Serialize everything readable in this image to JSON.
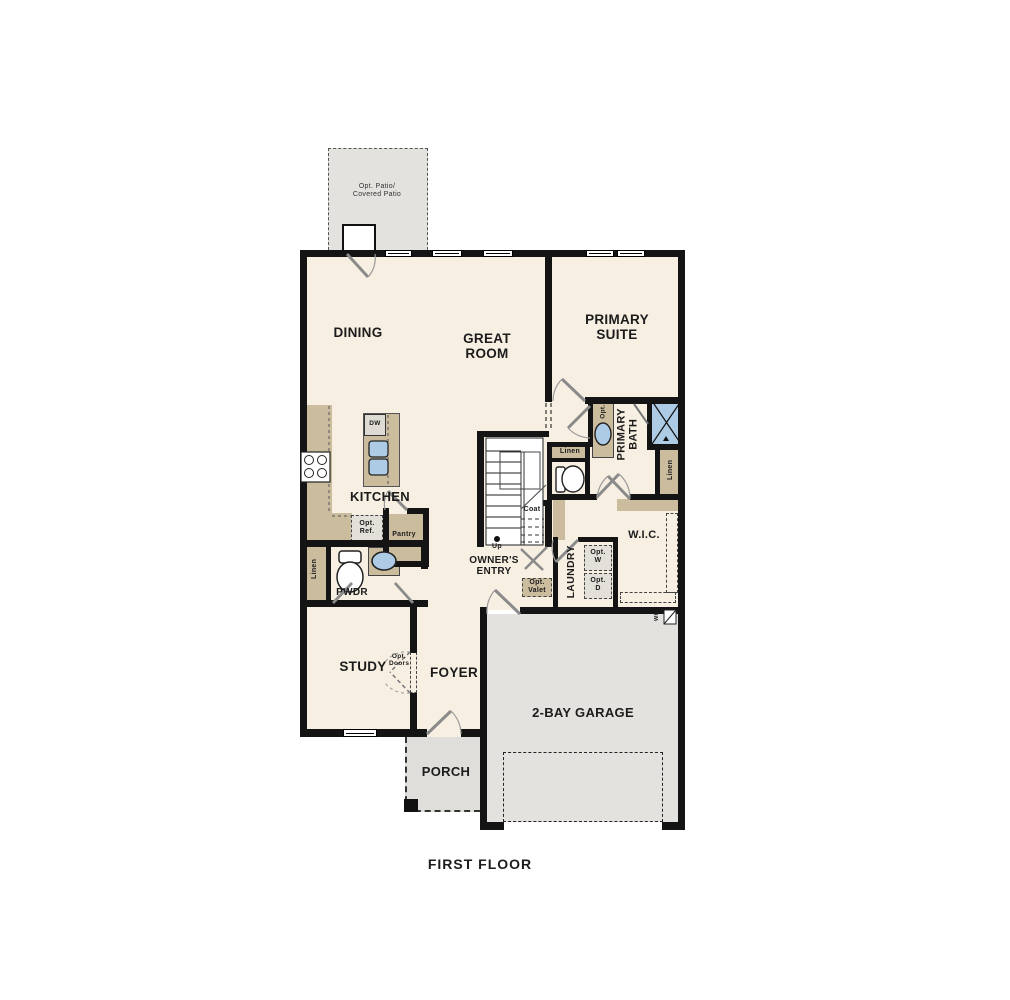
{
  "title": "FIRST FLOOR",
  "rooms": {
    "patio": {
      "label": "Opt. Patio/ Covered Patio"
    },
    "dining": {
      "label": "DINING"
    },
    "great_room": {
      "label": "GREAT ROOM"
    },
    "primary_suite": {
      "label": "PRIMARY SUITE"
    },
    "kitchen": {
      "label": "KITCHEN"
    },
    "pwdr": {
      "label": "PWDR"
    },
    "owners_entry": {
      "label": "OWNER'S ENTRY"
    },
    "laundry": {
      "label": "LAUNDRY"
    },
    "wic": {
      "label": "W.I.C."
    },
    "primary_bath": {
      "label": "PRIMARY BATH"
    },
    "study": {
      "label": "STUDY"
    },
    "foyer": {
      "label": "FOYER"
    },
    "porch": {
      "label": "PORCH"
    },
    "garage": {
      "label": "2-BAY GARAGE"
    }
  },
  "fixtures": {
    "dw": "DW",
    "pantry": "Pantry",
    "opt_ref": "Opt. Ref.",
    "linen_pwdr": "Linen",
    "linen_bath": "Linen",
    "linen_wic": "Linen",
    "coat": "Coat",
    "up": "Up",
    "opt_valet": "Opt. Valet",
    "opt_washer": "Opt. W",
    "opt_dryer": "Opt. D",
    "opt_vanity": "Opt.",
    "opt_doors": "Opt. Doors",
    "water_heater": "WH"
  },
  "colors": {
    "floor": "#f7efe2",
    "concrete": "#e4e2de",
    "counter": "#cbbc9e",
    "blue": "#aecbe6",
    "wall": "#141414"
  }
}
